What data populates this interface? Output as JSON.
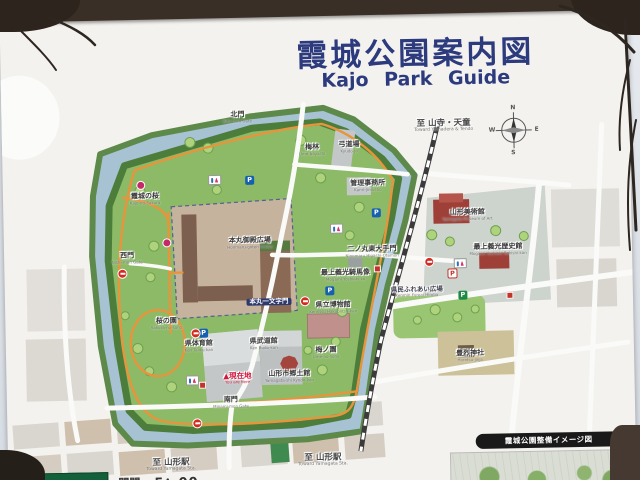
{
  "sign": {
    "title_ja": "霞城公園案内図",
    "title_en": "Kajo Park Guide"
  },
  "compass": {
    "n": "N",
    "e": "E",
    "s": "S",
    "w": "W"
  },
  "directions": [
    {
      "ja": "至 山寺・天童",
      "en": "Toward Yamadera & Tendo"
    },
    {
      "ja": "至 山形駅",
      "en": "Toward Yamagata Sta."
    },
    {
      "ja": "至 山形駅",
      "en": "Toward Yamagata Sta."
    }
  ],
  "places": [
    {
      "ja": "北門",
      "en": "Kita-mon Gate"
    },
    {
      "ja": "梅林",
      "en": "Ume-bayashi"
    },
    {
      "ja": "弓道場",
      "en": "Kyudo-jo"
    },
    {
      "ja": "管理事務所",
      "en": "Kanri-jimusho"
    },
    {
      "ja": "霞城の桜",
      "en": "Kajo-no-Sakura"
    },
    {
      "ja": "西門",
      "en": "Nishi-mon Gate"
    },
    {
      "ja": "本丸御殿広場",
      "en": "Honmaru-goten hiroba"
    },
    {
      "ja": "本丸一文字門",
      "en": "Honmaru Ichimonji-mon"
    },
    {
      "ja": "二ノ丸東大手門",
      "en": "Ninomaru Higashi-Otemon"
    },
    {
      "ja": "最上義光騎馬像",
      "en": "Mogami Yoshiaki-zo"
    },
    {
      "ja": "県立博物館",
      "en": "Kenritsu Hakubutsu-kan"
    },
    {
      "ja": "桜の園",
      "en": "Sakura-no-sono"
    },
    {
      "ja": "県体育館",
      "en": "Ken Taiiku-kan"
    },
    {
      "ja": "県武道館",
      "en": "Ken Budo-kan"
    },
    {
      "ja": "梅ノ園",
      "en": "Ume-no-sono"
    },
    {
      "ja": "山形市郷土館",
      "en": "Yamagata-shi Kyodo-kan"
    },
    {
      "ja": "▲現在地",
      "en": "You are here"
    },
    {
      "ja": "南門",
      "en": "Minami-mon Gate"
    },
    {
      "ja": "山形美術館",
      "en": "Yamagata Museum of Art"
    },
    {
      "ja": "最上義光歴史館",
      "en": "Mogami Yoshiaki Rekishi-kan"
    },
    {
      "ja": "県民ふれあい広場",
      "en": "Kenmin Fureai Hiroba"
    },
    {
      "ja": "豊烈神社",
      "en": "Horetsu-jinja"
    }
  ],
  "footer": {
    "park_name": "霞城公園",
    "gate_label": "開門",
    "gate_time": "5：00"
  },
  "inset": {
    "title": "霞城公園整備イメージ図"
  },
  "icons": {
    "parking_letter": "P"
  }
}
